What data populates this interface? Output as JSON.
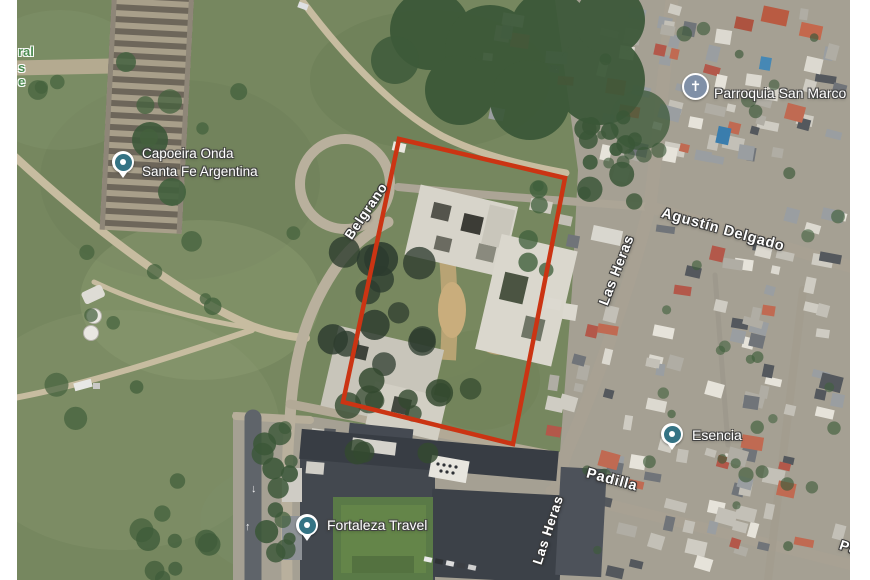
{
  "window": {
    "background": "#ffffff"
  },
  "map": {
    "type": "satellite",
    "accent_colors": {
      "annotation_red": "#cb3413",
      "pin_teal": "#347384",
      "church_blue_gray": "#8090a7",
      "park_text_green": "#4a8a4f",
      "label_white": "#ffffff"
    },
    "annotation_rectangle": {
      "color": "#cb3413",
      "stroke_width": 4.5,
      "corners": [
        [
          399,
          139
        ],
        [
          565,
          178
        ],
        [
          513,
          444
        ],
        [
          343,
          402
        ]
      ]
    },
    "place_labels": [
      {
        "name": "capoeira-onda",
        "icon": "place-pin-icon",
        "pin": [
          123,
          162
        ],
        "text_x": 142,
        "text_y": 163,
        "align": "left",
        "font_size": 13.5,
        "lines": [
          "Capoeira Onda",
          "Santa Fe Argentina"
        ]
      },
      {
        "name": "parroquia-san-marco",
        "icon": "church-icon",
        "pin": [
          695,
          86
        ],
        "text_x": 714,
        "text_y": 93,
        "align": "left",
        "font_size": 14,
        "lines": [
          "Parroquia San Marco"
        ]
      },
      {
        "name": "ananke-analytics",
        "icon": "none",
        "text_x": 857,
        "text_y": 133,
        "align": "right",
        "font_size": 13.5,
        "lines": [
          "Ananké",
          "Analytics and In"
        ]
      },
      {
        "name": "esencia",
        "icon": "place-pin-icon",
        "pin": [
          672,
          434
        ],
        "text_x": 692,
        "text_y": 435,
        "align": "left",
        "font_size": 14,
        "lines": [
          "Esencia"
        ]
      },
      {
        "name": "fortaleza-travel",
        "icon": "place-pin-icon",
        "pin": [
          307,
          525
        ],
        "text_x": 327,
        "text_y": 525,
        "align": "left",
        "font_size": 14,
        "lines": [
          "Fortaleza Travel"
        ]
      }
    ],
    "street_labels": [
      {
        "text": "Belgrano",
        "x": 366,
        "y": 211,
        "angle": -56,
        "font_size": 13.5
      },
      {
        "text": "Agustín Delgado",
        "x": 723,
        "y": 230,
        "angle": 15.5,
        "font_size": 14.5
      },
      {
        "text": "Las Heras",
        "x": 616,
        "y": 270,
        "angle": -69,
        "font_size": 14
      },
      {
        "text": "Padilla",
        "x": 612,
        "y": 480,
        "angle": 15,
        "font_size": 14.5
      },
      {
        "text": "Las Heras",
        "x": 548,
        "y": 530,
        "angle": -72,
        "font_size": 13.5
      },
      {
        "text": "Pa",
        "x": 849,
        "y": 547,
        "angle": 18,
        "font_size": 14
      }
    ],
    "park_label_fragments": [
      {
        "text": "ral",
        "x": 18,
        "y": 52
      },
      {
        "text": "s",
        "x": 18,
        "y": 68
      },
      {
        "text": "e",
        "x": 18,
        "y": 82
      }
    ]
  }
}
